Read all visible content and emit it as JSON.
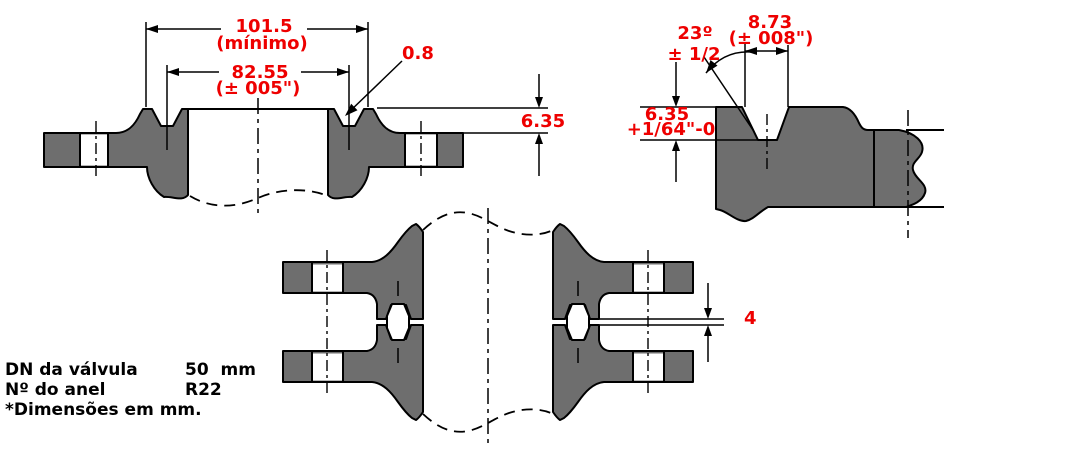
{
  "colors": {
    "dimension_red": "#ee0000",
    "section_gray": "#6e6e6e",
    "line_black": "#000000",
    "background": "#ffffff"
  },
  "views": {
    "flange_face": {
      "outer_width": "101.5",
      "outer_width_note": "(mínimo)",
      "groove_pitch": "82.55",
      "groove_pitch_tol": "(± 005\")",
      "groove_edge_radius": "0.8",
      "raised_face_height": "6.35"
    },
    "groove_detail": {
      "angle": "23º",
      "angle_tol": "± 1/2",
      "groove_width": "8.73",
      "groove_width_tol": "(± 008\")",
      "groove_depth": "6.35",
      "groove_depth_tol": "+1/64\"-0"
    },
    "assembly": {
      "flange_gap": "4"
    }
  },
  "notes": {
    "rows": [
      {
        "label": "DN da válvula",
        "value": "50  mm"
      },
      {
        "label": "Nº do anel",
        "value": "R22"
      }
    ],
    "footnote": "*Dimensões em mm."
  }
}
